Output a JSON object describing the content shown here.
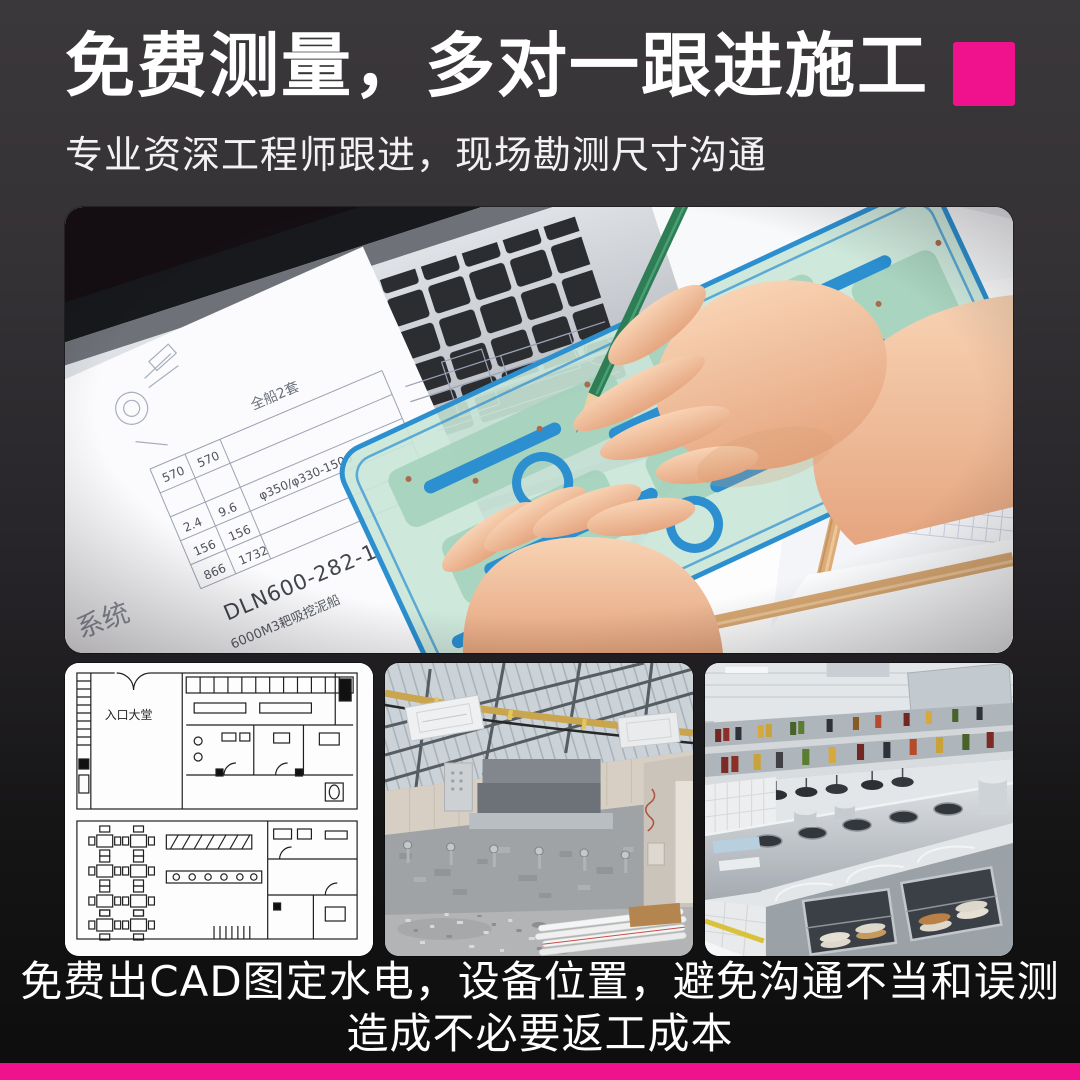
{
  "theme": {
    "accent": "#F0128C",
    "background_top": "#3B383B",
    "background_bottom": "#0D0D0D",
    "text_color": "#FFFFFF"
  },
  "header": {
    "title": "免费测量，多对一跟进施工",
    "subtitle": "专业资深工程师跟进，现场勘测尺寸沟通"
  },
  "hero": {
    "drawing": {
      "sheet_label": "全船2套",
      "table_col1": [
        "570",
        "2.4",
        "156",
        "866"
      ],
      "table_col2": [
        "570",
        "9.6",
        "156",
        "1732"
      ],
      "spec": "φ350/φ330-1500",
      "drawing_no": "DLN600-282-1",
      "project_no": "6000M3耙吸挖泥船",
      "system_label": "系统"
    }
  },
  "gallery": {
    "floor_plan": {
      "lobby_label": "入口大堂"
    }
  },
  "footer": {
    "line1": "免费出CAD图定水电，设备位置，避免沟通不当和误测",
    "line2": "造成不必要返工成本"
  }
}
